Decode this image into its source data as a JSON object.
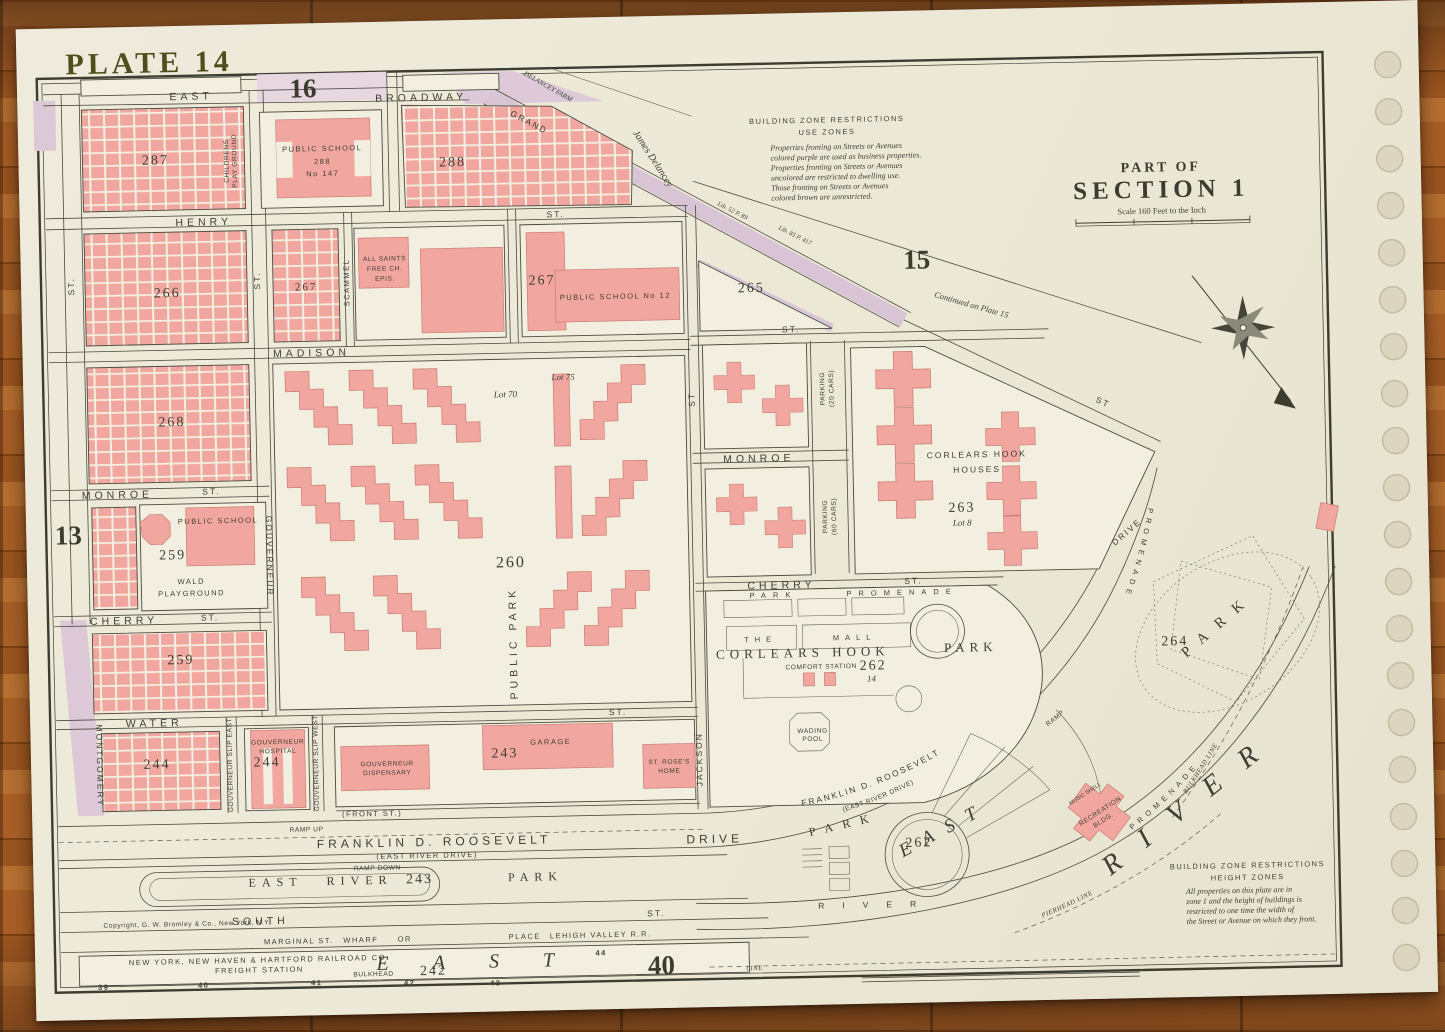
{
  "plate": {
    "title": "PLATE 14",
    "neighbor_top": "16",
    "neighbor_right": "15",
    "neighbor_left": "13",
    "neighbor_bottom": "40"
  },
  "title_block": {
    "part_of": "PART OF",
    "section": "SECTION 1",
    "scale": "Scale 160 Feet to the Inch"
  },
  "legend_use": {
    "h1": "BUILDING ZONE RESTRICTIONS",
    "h2": "USE ZONES",
    "l1": "Properties fronting on Streets or Avenues",
    "l2": "colored purple are used as business properties.",
    "l3": "Properties fronting on Streets or Avenues",
    "l4": "uncolored are restricted to dwelling use.",
    "l5": "Those fronting on Streets or Avenues",
    "l6": "colored brown are unrestricted."
  },
  "legend_height": {
    "h1": "BUILDING ZONE RESTRICTIONS",
    "h2": "HEIGHT ZONES",
    "l1": "All properties on this plate are in",
    "l2": "zone 1 and the height of buildings is",
    "l3": "restricted to one time the width of",
    "l4": "the Street or Avenue on which they front."
  },
  "notes": {
    "copyright": "Copyright, G. W. Bromley & Co., New York, N.Y.",
    "continued": "Continued on Plate 15",
    "james_delancey": "James Delancey",
    "delancey_farm": "DELANCEY FARM",
    "deed_a": "Lib. 52 P. 89",
    "deed_b": "Lib. 85 P. 417"
  },
  "streets": {
    "east": "EAST",
    "broadway": "BROADWAY",
    "grand": "GRAND",
    "henry": "HENRY",
    "henry_st": "ST.",
    "madison": "MADISON",
    "madison_st": "ST.",
    "madison_st_diag": "ST",
    "monroe_w": "MONROE",
    "monroe_w_st": "ST.",
    "monroe_e": "MONROE",
    "cherry_w": "CHERRY",
    "cherry_w_st": "ST.",
    "cherry_e": "CHERRY",
    "cherry_e_st": "ST.",
    "water": "WATER",
    "water_st": "ST.",
    "south": "SOUTH",
    "south_st": "ST.",
    "front": "(FRONT ST.)",
    "left_st": "ST.",
    "mid_st": "ST.",
    "scammel": "SCAMMEL",
    "gouverneur": "GOUVERNEUR",
    "montgomery": "MONTGOMERY",
    "slip_east": "GOUVERNEUR SLIP EAST",
    "slip_west": "GOUVERNEUR SLIP WEST",
    "jackson": "JACKSON",
    "jackson_st": "ST",
    "fdr_w": "FRANKLIN D. ROOSEVELT",
    "fdr_w_sub": "(EAST RIVER DRIVE)",
    "fdr_w_drive": "DRIVE",
    "fdr_e": "FRANKLIN D. ROOSEVELT",
    "fdr_e_sub": "(EAST RIVER DRIVE)",
    "drive_e": "DRIVE",
    "ramp_up": "RAMP UP",
    "ramp_down": "RAMP DOWN",
    "ramp": "RAMP",
    "marginal": "MARGINAL ST.",
    "wharf": "WHARF",
    "or_word": "OR",
    "place": "PLACE",
    "lehigh": "LEHIGH VALLEY R.R.",
    "line_word": "LINE"
  },
  "blocks": {
    "b287": "287",
    "b288_school": "288",
    "b288": "288",
    "b266": "266",
    "b267_mid": "267",
    "b267": "267",
    "b265": "265",
    "b268": "268",
    "b260": "260",
    "b259_wald": "259",
    "b259": "259",
    "b263": "263",
    "b262_park": "262",
    "b262_lot": "14",
    "b262_river": "262",
    "b264": "264",
    "b244_w": "244",
    "b244_hosp": "244",
    "b243": "243",
    "b243_park": "243",
    "b242": "242",
    "lot70": "Lot 70",
    "lot75": "Lot 75",
    "lot8": "Lot 8"
  },
  "buildings": {
    "childrens": "CHILDRENS",
    "play_ground": "PLAY GROUND",
    "ps288_1": "PUBLIC SCHOOL",
    "ps288_2": "288",
    "ps288_3": "No 147",
    "all_saints_1": "ALL SAINTS",
    "all_saints_2": "FREE CH.",
    "all_saints_3": "EPIS.",
    "ps12": "PUBLIC SCHOOL No 12",
    "ps259": "PUBLIC SCHOOL",
    "wald_1": "WALD",
    "wald_2": "PLAYGROUND",
    "public_park": "PUBLIC PARK",
    "chh_1": "CORLEARS HOOK",
    "chh_2": "HOUSES",
    "parking20_1": "PARKING",
    "parking20_2": "(20 CARS)",
    "parking60_1": "PARKING",
    "parking60_2": "(60 CARS)",
    "hospital_1": "GOUVERNEUR",
    "hospital_2": "HOSPITAL",
    "dispensary_1": "GOUVERNEUR",
    "dispensary_2": "DISPENSARY",
    "garage": "GARAGE",
    "st_roses_1": "ST. ROSE'S",
    "st_roses_2": "HOME",
    "comfort_station": "COMFORT STATION",
    "wading_1": "WADING",
    "wading_2": "POOL",
    "recreation_1": "RECREATION",
    "recreation_2": "BLDG.",
    "music_shell": "MUSIC SHELL",
    "freight_1": "NEW YORK, NEW HAVEN & HARTFORD RAILROAD CO.",
    "freight_2": "FREIGHT STATION"
  },
  "park": {
    "park_promenade": "PARK PROMENADE",
    "the_word": "THE",
    "mall": "MALL",
    "corlears_hook": "CORLEARS HOOK",
    "park_word": "PARK",
    "erp_east": "EAST",
    "erp_river": "RIVER",
    "erp_park": "PARK",
    "promenade_inner": "PROMENADE",
    "promenade_outer": "PROMENADE",
    "park_diag": "PARK"
  },
  "river": {
    "east_inner": "EAST",
    "river_small": "RIVER",
    "east_bottom": "EAST",
    "river_big": "RIVER",
    "bulkhead": "BULKHEAD",
    "bulkhead_line": "BULKHEAD LINE",
    "pierhead_line": "PIERHEAD LINE"
  },
  "piers": {
    "p39": "39",
    "p40": "40",
    "p41": "41",
    "p42": "42",
    "p43": "43",
    "p44": "44"
  },
  "colors": {
    "paper": "#ece8d8",
    "map_ink": "#3e3e34",
    "building_pink": "#f1a79f",
    "business_purple": "#d8c4d4",
    "plate_olive": "#4f4f1d",
    "wood": "#9c5820"
  }
}
